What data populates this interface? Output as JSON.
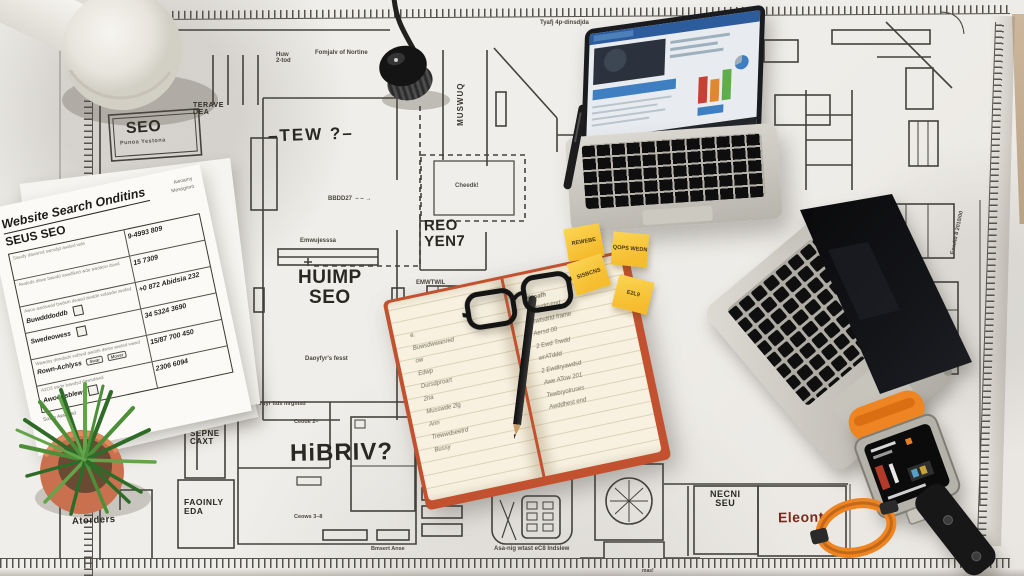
{
  "palette": {
    "paper": "#f1efeb",
    "line": "#44423c",
    "sticky": "#f5bc2e",
    "accent_red": "#7a2a1a",
    "desk": "#c9b49a"
  },
  "labels": {
    "seo_box": {
      "title": "SEO",
      "subtitle": "Punoa Yestona"
    },
    "terave": {
      "l1": "TERAVE",
      "l2": "DEA"
    },
    "tew": "–TEW ?–",
    "huw": "Huw\n2-tod",
    "fomjalv": "Fomjalv of Nortine",
    "tyafj": "Tyafj 4p-dinsdjda",
    "bbdd": "BBDD27  – – →",
    "muswuq": "MUSWUQ",
    "cheedk": "Cheedk!",
    "reo": {
      "l1": "REO",
      "l2": "YEN7"
    },
    "emwujesssa": "Emwujesssa",
    "huimp": {
      "l1": "HUIMP",
      "l2": "SEO"
    },
    "daoyfyr": "Daoyfyr's fesst",
    "emwtwil": "EMWTWIL",
    "duwyr": "Duwyr ftds mrgmsd",
    "ceoue": "Ceoue 2–",
    "ceows": "Ceows 3–8",
    "hibriv": "HiBRIV?",
    "bmsert": "Bmsert Anse",
    "pronm": "PRONM",
    "pronm_caption": "Asa-nig wtast eC8 Indslew",
    "sprat": "Sprat al'rw\nLound",
    "necni": {
      "l1": "NECNI",
      "l2": "SEU"
    },
    "eleont": "Eleont",
    "sepne": {
      "l1": "SEPNE",
      "l2": "CAXT"
    },
    "faoinly": {
      "l1": "FAOINLY",
      "l2": "EDA"
    },
    "atorders": "Atorders",
    "undersheet": "Asoerjes fum forbeer",
    "eswad": "EswAd 8 2010/00",
    "mas": "mas!"
  },
  "checklist": {
    "title": "Website Search Onditins",
    "subtitle": "SEUS SEO",
    "col_note1": "Awoamy",
    "col_note2": "Messgnmt",
    "rows": [
      {
        "label": "",
        "scribble": "Sawdy dawsmd swmdjd awded wde",
        "value": "9-4993 809"
      },
      {
        "label": "",
        "scribble": "Awdeds dswe bawdd sawdlked wde awdasw dswd",
        "value": "15 7309"
      },
      {
        "label": "Buwdddoddb",
        "scribble": "Awos awdswdd bwdsm dwasd awdde wdasdw awdsd",
        "value": "+0 872 Abidsia 232"
      },
      {
        "label": "Swedeowess",
        "scribble": "",
        "value": "34 5324 3690"
      },
      {
        "label": "Rown-Achlyss",
        "scribble": "Wawdsy dswdads wdswd awdds dwsw awdsd wawd",
        "value": "15/87 700 450",
        "chip1": "Swar",
        "chip2": "Mover"
      },
      {
        "label": "Awoodsblew",
        "scribble": "A2O3 swde bawdsd dawsdawd",
        "value": "2306 6094"
      }
    ],
    "footer": "Soam Awwwsd"
  },
  "sticky_notes": [
    {
      "text": "REWEBE"
    },
    {
      "text": "QOPS WEDN"
    },
    {
      "text": "SISBCNS"
    },
    {
      "text": "E2L9"
    }
  ],
  "notebook": {
    "left_lines": [
      "e.",
      "Buwsdwwanred",
      "ow",
      "Edwp",
      "Dursdproart",
      "2na",
      "Musswde 2lg",
      "Ann",
      "Trewwdseetrd",
      "Bussy"
    ],
    "right_header": "Keoafh",
    "right_lines": [
      "Eepydrt-tmd",
      "Gwtsdrtd frame",
      "Aersd 00",
      "2 Ewd Trwdd",
      "wrATddd",
      "2 Ewdtryawdsd",
      "Awe ATow 201",
      "Tewbryolruses",
      "Awddhest end"
    ]
  }
}
